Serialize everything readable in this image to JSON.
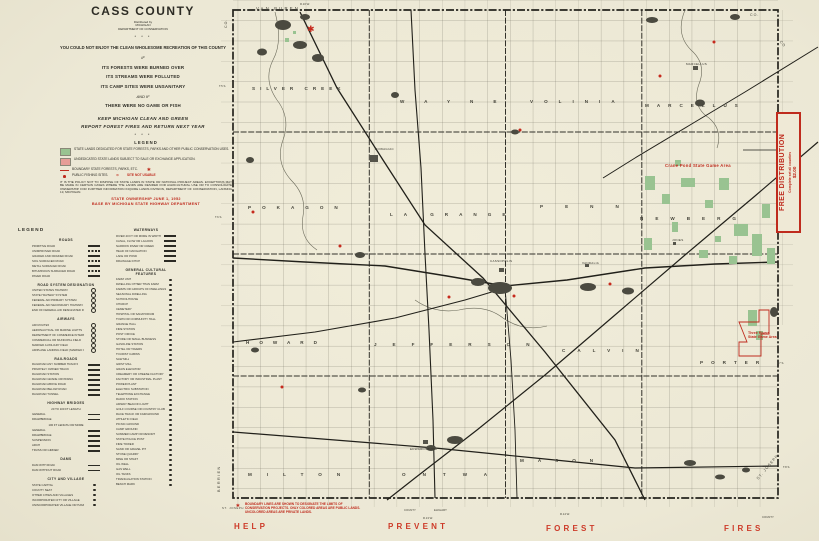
{
  "icons": {
    "star": "✱",
    "site_not_usable_ring": "⊙"
  },
  "title_block": {
    "title": "CASS COUNTY",
    "distributed_by": "Distributed by",
    "agency1": "MICHIGAN",
    "agency2": "DEPARTMENT OF CONSERVATION",
    "stars": "* * *",
    "intro": "YOU COULD NOT ENJOY THE CLEAN WHOLESOME RECREATION OF THIS COUNTY",
    "if1": "IF",
    "line_forests": "ITS FORESTS WERE BURNED OVER",
    "line_streams": "ITS STREAMS WERE POLLUTED",
    "line_camps": "ITS CAMP SITES WERE UNSANITARY",
    "and_if": "AND IF",
    "line_game": "THERE WERE NO GAME OR FISH",
    "keep": "KEEP MICHIGAN CLEAN AND GREEN",
    "report": "REPORT FOREST FIRES AND RETURN NEXT YEAR"
  },
  "conservation_legend": {
    "heading": "LEGEND",
    "items": [
      {
        "label": "STATE LANDS DEDICATED FOR STATE FORESTS, PARKS AND OTHER PUBLIC CONSERVATION USES."
      },
      {
        "label": "UNDEDICATED STATE LANDS SUBJECT TO SALE OR EXCHANGE APPLICATION."
      },
      {
        "label": "BOUNDARY STATE FORESTS, PARKS, ETC."
      },
      {
        "label": "PUBLIC FISHING SITES."
      }
    ],
    "site_not_usable": "SITE NOT USABLE",
    "policy": "IT IS THE POLICY NOT TO DISPOSE OF STATE LANDS IN STATE OR NATIONAL PROJECT AREAS. EXCEPTIONS MAY BE MADE IN CERTAIN CASES WHERE THE LANDS ARE DESIRED FOR AGRICULTURAL USE OR TO CONSOLIDATE OWNERSHIP. FOR FURTHER INFORMATION INQUIRE LANDS DIVISION, DEPARTMENT OF CONSERVATION, LANSING 13, MICHIGAN.",
    "ownership_line": "STATE OWNERSHIP JUNE 1, 1952",
    "base_line": "BASE BY MICHIGAN STATE HIGHWAY DEPARTMENT"
  },
  "legend2": {
    "headings": {
      "legend": "LEGEND",
      "roads": "ROADS",
      "road_system": "ROAD SYSTEM DESIGNATION",
      "airways": "AIRWAYS",
      "railroads": "RAILROADS",
      "bridges": "HIGHWAY BRIDGES",
      "dams": "DAMS",
      "city_village": "CITY AND VILLAGE",
      "waterways": "WATERWAYS",
      "cultural": "GENERAL CULTURAL FEATURES"
    },
    "roads": [
      "PRIMITIVE ROAD",
      "UNIMPROVED ROAD",
      "GRADED AND DRAINED ROAD",
      "SOIL SURFACED ROAD",
      "METAL SURFACED ROAD",
      "BITUMINOUS SURFACED ROAD",
      "PAVED ROAD"
    ],
    "road_system": [
      "UNITED STATES HIGHWAY",
      "STATE HIGHWAY SYSTEM",
      "FEDERAL AID PRIMARY SYSTEM",
      "FEDERAL AID SECONDARY HIGHWAY SYSTEM",
      "END OF FEDERAL AID DESIGNATED ROUTE"
    ],
    "airways": [
      "AIR ROUTES",
      "AERONAUTICAL OR MARINE LIGHTS",
      "DEPARTMENT OF COMMERCE INTERMEDIATE FIELD",
      "COMMERCIAL OR MUNICIPAL FIELD",
      "MARKED AUXILIARY FIELD",
      "AIRPLANE LANDING FIELD (MARKED OR EMERGENCY)"
    ],
    "railroads": [
      "RAILROAD ANY NUMBER TRACKS",
      "PRIVATELY OWNED TRACK",
      "RAILROAD STATION",
      "RAILROAD GRADE CROSSING",
      "RAILROAD ABOVE ROAD",
      "RAILROAD BELOW ROAD",
      "RAILROAD TUNNEL"
    ],
    "bridges": {
      "sub1": "20 TO 100 FT LENGTH",
      "sub2": "100 FT LENGTH OR MORE",
      "a": [
        "GENERAL",
        "DRAWBRIDGE"
      ],
      "b": [
        "GENERAL",
        "DRAWBRIDGE",
        "SUSPENSION",
        "ARCH",
        "TRUSS OR GIRDER"
      ]
    },
    "dams": [
      "DAM WITH ROAD",
      "DAM WITHOUT ROAD"
    ],
    "city_village": [
      "STATE CAPITAL",
      "COUNTY SEAT",
      "OTHER CITIES AND VILLAGES",
      "INCORPORATED CITY OR VILLAGE",
      "UNINCORPORATED VILLAGE OR HAMLET"
    ],
    "waterways": [
      "RIVER 40 FT OR MORE IN WIDTH",
      "CANAL, FLOW OR LAGOON",
      "NARROW RIVER OR CREEK",
      "HEAD OF NAVIGATION",
      "LAKE OR POND",
      "DRAINAGE DITCH"
    ],
    "cultural": [
      "FARM UNIT",
      "DWELLING OTHER THAN FARM",
      "FARMS OR GROUPS OF DWELLINGS",
      "SEASONAL DWELLING",
      "SCHOOLHOUSE",
      "CHURCH",
      "CEMETERY",
      "HOSPITAL OR SANATORIUM",
      "TOWN OR COMMUNITY HALL",
      "GRANGE HALL",
      "FIRE STATION",
      "POST OFFICE",
      "STORE OR SMALL BUSINESS",
      "GASOLINE STATION",
      "HOTEL OR TAVERN",
      "TOURIST CABINS",
      "SAW MILL",
      "GRIST MILL",
      "GRAIN ELEVATOR",
      "CREAMERY OR CHEESE FACTORY",
      "FACTORY OR INDUSTRIAL PLANT",
      "POWER PLANT",
      "ELECTRIC SUBSTATION",
      "TELEPHONE EXCHANGE",
      "RADIO STATION",
      "AIRWAY BEACON LIGHT",
      "GOLF COURSE OR COUNTRY CLUB",
      "RACE TRACK OR FAIRGROUND",
      "ATHLETIC FIELD",
      "PICNIC GROUND",
      "CAMP GROUND",
      "SUMMER CAMP OR RESORT",
      "STATE POLICE POST",
      "FIRE TOWER",
      "SAND OR GRAVEL PIT",
      "STONE QUARRY",
      "MINE OR SHAFT",
      "OIL WELL",
      "GAS WELL",
      "OIL TANKS",
      "TRIANGULATION STATION",
      "BENCH MARK"
    ]
  },
  "map": {
    "neighbor_labels": {
      "north": "VAN BUREN",
      "west": "BERRIEN",
      "east": "ST. JOSEPH",
      "south_west": "ST. JOSEPH",
      "south_east_county": "ELKHART",
      "co1": "CO.",
      "co2": "CO.",
      "co3": "CO",
      "county1": "COUNTY",
      "county2": "COUNTY"
    },
    "townships": [
      "SILVER CREEK",
      "WAYNE",
      "VOLINIA",
      "MARCELLUS",
      "POKAGON",
      "LA GRANGE",
      "PENN",
      "NEWBERG",
      "HOWARD",
      "JEFFERSON",
      "CALVIN",
      "PORTER",
      "MILTON",
      "ONTWA",
      "MASON"
    ],
    "cities": [
      "DOWAGIAC",
      "CASSOPOLIS",
      "VANDALIA",
      "EDWARDSBURG",
      "MARCELLUS",
      "JONES"
    ],
    "game_areas": {
      "crane_pond": "Crane Pond State Game Area",
      "three_rivers_1": "Three Rivers",
      "three_rivers_2": "State Game Area"
    },
    "ticks": {
      "t5s": "T.5 S.",
      "t6s": "T.6 S.",
      "t7s": "T.7 S.",
      "t8s": "T.8 S.",
      "r16w": "R.16 W.",
      "r14w": "R.14 W.",
      "r13w": "R.13 W."
    },
    "boundary_note": [
      "BOUNDARY LINES ARE SHOWN TO DESIGNATE THE LIMITS OF",
      "CONSERVATION PROJECTS. ONLY COLORED AREAS ARE PUBLIC LANDS.",
      "UNCOLORED AREAS ARE PRIVATE LANDS."
    ],
    "slogan": [
      "HELP",
      "PREVENT",
      "FOREST",
      "FIRES"
    ]
  },
  "free_distribution": {
    "line1": "FREE DISTRIBUTION",
    "line2": "Complete set all counties",
    "line3": "$2.00"
  },
  "colors": {
    "red": "#bf2b1d",
    "state_land_green": "#99c391",
    "undedicated_pink": "#e69d97",
    "paper": "#ece8d5"
  }
}
